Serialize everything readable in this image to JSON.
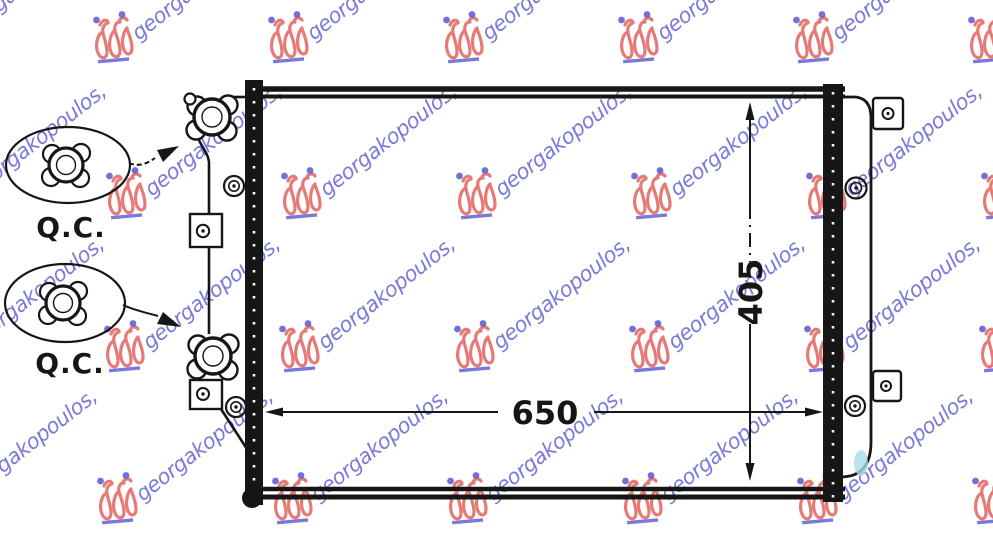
{
  "colors": {
    "line": "#161616",
    "paper": "#ffffff",
    "watermark_text": "#6c6cd4",
    "watermark_logo": "#e2635f",
    "watermark_accent": "#4646cc",
    "smudge": "#a8dce8"
  },
  "watermark": {
    "text": "georgakopoulos,"
  },
  "dimensions": {
    "width_label": "650",
    "height_label": "405"
  },
  "callouts": {
    "top_label": "Q.C.",
    "bottom_label": "Q.C."
  }
}
